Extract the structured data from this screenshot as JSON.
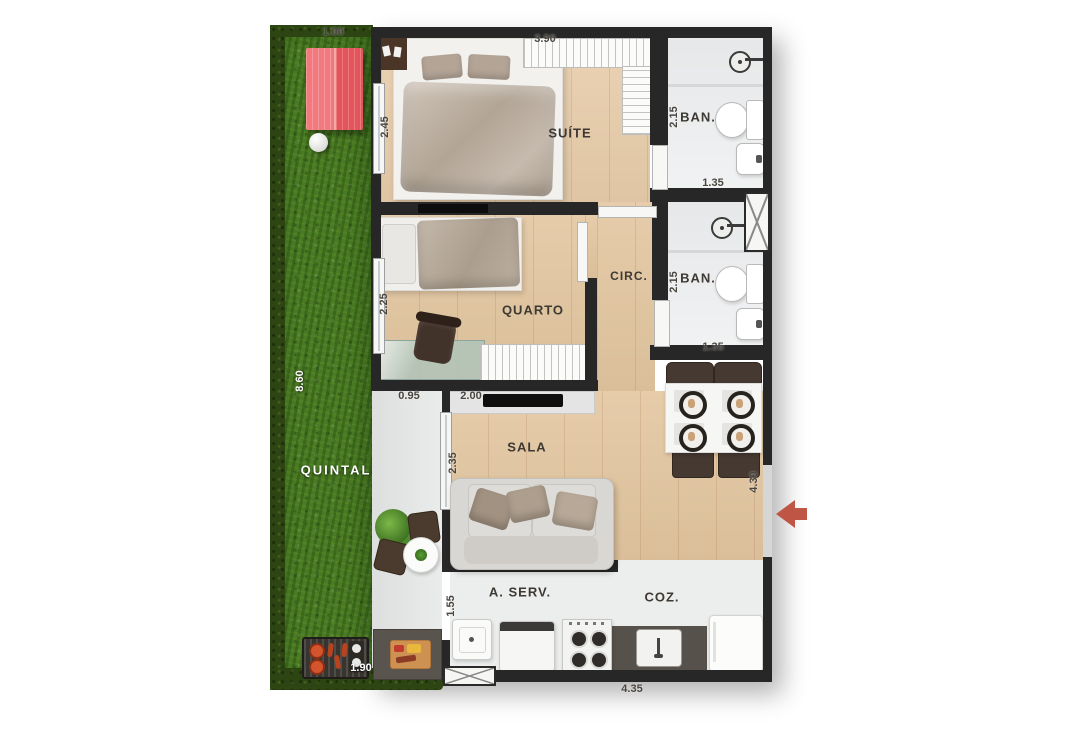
{
  "plan_title": "2-bedroom apartment floor plan with backyard",
  "rooms": {
    "quintal": "QUINTAL",
    "suite": "SUÍTE",
    "ban_suite": "BAN.",
    "quarto": "QUARTO",
    "circ": "CIRC.",
    "ban_social": "BAN.",
    "sala": "SALA",
    "aserv": "A. SERV.",
    "coz": "COZ."
  },
  "dimensions": {
    "d1_00": "1.00",
    "d3_90": "3.90",
    "d2_45": "2.45",
    "d2_15a": "2.15",
    "d1_35a": "1.35",
    "d2_25": "2.25",
    "d2_15b": "2.15",
    "d1_35b": "1.35",
    "d8_60": "8.60",
    "d0_95": "0.95",
    "d2_00": "2.00",
    "d2_35": "2.35",
    "d4_30": "4.30",
    "d1_55": "1.55",
    "d1_90": "1.90",
    "d4_35": "4.35"
  },
  "colors": {
    "wall": "#272727",
    "wood_floor": "#e3c6a0",
    "grass": "#4a7a23",
    "hedge": "#2c4512",
    "pet_house_red": "#e8575c",
    "entry_arrow": "#bf5645"
  }
}
